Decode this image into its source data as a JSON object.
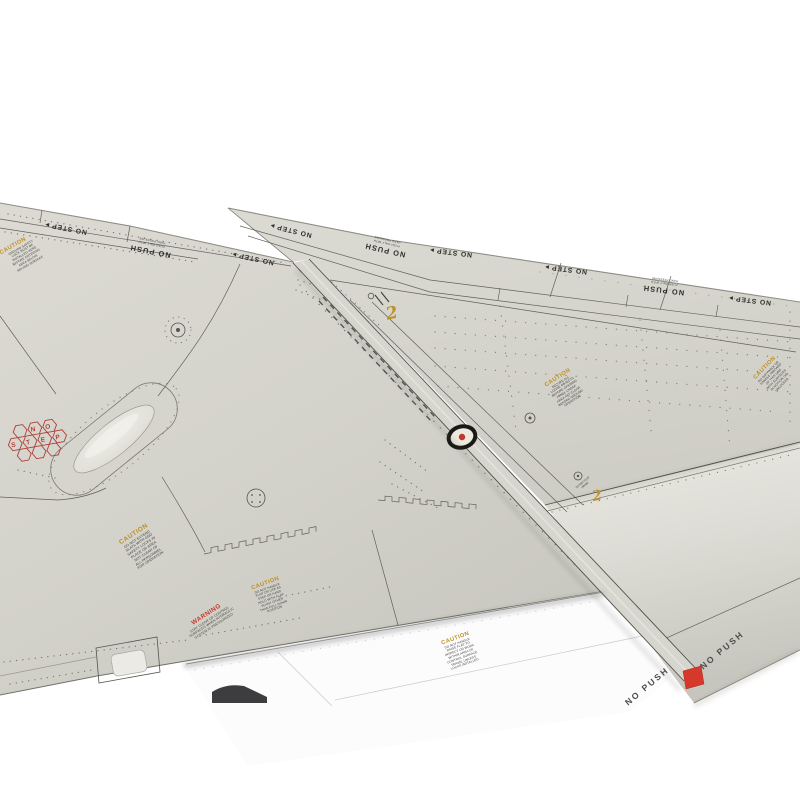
{
  "image": {
    "subject": "Scale model aircraft wing panels with maintenance stencil markings photographed on a white background"
  },
  "colors": {
    "background": "#ffffff",
    "wing_grey": "#d6d5cd",
    "panel_line": "#55554f",
    "stencil_black": "#2e2e2a",
    "caution_amber": "#bd8f25",
    "warning_red": "#c23b2c",
    "marker_red": "#c3362b",
    "flag_red": "#d6392b",
    "hex_red": "#ad4039",
    "flap_white": "#fcfcfd"
  },
  "markings": {
    "no_step": "NO STEP",
    "no_push": "NO PUSH",
    "caution": "CAUTION",
    "warning": "WARNING",
    "flap_number": "2",
    "hex_letters": [
      "N",
      "O",
      "S",
      "T",
      "E",
      "P"
    ],
    "fine_print": [
      "PUSH ONLY WITH",
      "HAND PRESSURE"
    ],
    "warning_lines": [
      "STAY CLEAR OF CONTROL",
      "SURFACES WHEN HYDRAULIC",
      "SYSTEM IS PRESSURIZED"
    ],
    "hinge_note": [
      "OUTBD FLAP",
      "HINGE"
    ],
    "caution_lines_a": [
      "DO NOT EXTEND",
      "SLATS WITH GND",
      "SAFETY LOCKS IN",
      "PLACE OR AREA",
      "NOT CLEAR OF",
      "ALL PERSONNEL",
      "FOR OPERATION"
    ],
    "caution_lines_b": [
      "DO NOT HANDLE",
      "FLAP OR USE AS",
      "STEP OR HAND",
      "HOLD WITH FLAP",
      "IN ANY OTHER",
      "THAN FULL DOWN",
      "POSITION"
    ],
    "caution_lines_c": [
      "SECURE ALL",
      "LOOSE OBJECTS",
      "BEFORE OPENING",
      "PANEL CHECK",
      "AREA AFT CLEAR",
      "BEFORE GROUND",
      "OPERATION"
    ],
    "caution_lines_d": [
      "DO NOT WALK OR",
      "HANDLE INBOARD",
      "OF THIS LINE",
      "WITH SURFACES",
      "IN MOTION OR",
      "UNLOCKED"
    ],
    "caution_lines_e": [
      "DO NOT HANDLE",
      "RAISE FLAP TO",
      "INSPECT OR WORK",
      "WITHIN AREA OF",
      "CONTROL SURFACE",
      "TRAVEL UNLESS",
      "LOCKS INSTALLED"
    ],
    "caution_lines_f": [
      "GROUND SAFETY",
      "LOCK MUST BE",
      "INSTALLED HERE",
      "BEFORE ENTERING",
      "AREA BELOW",
      "MOVING SURFACE"
    ]
  }
}
